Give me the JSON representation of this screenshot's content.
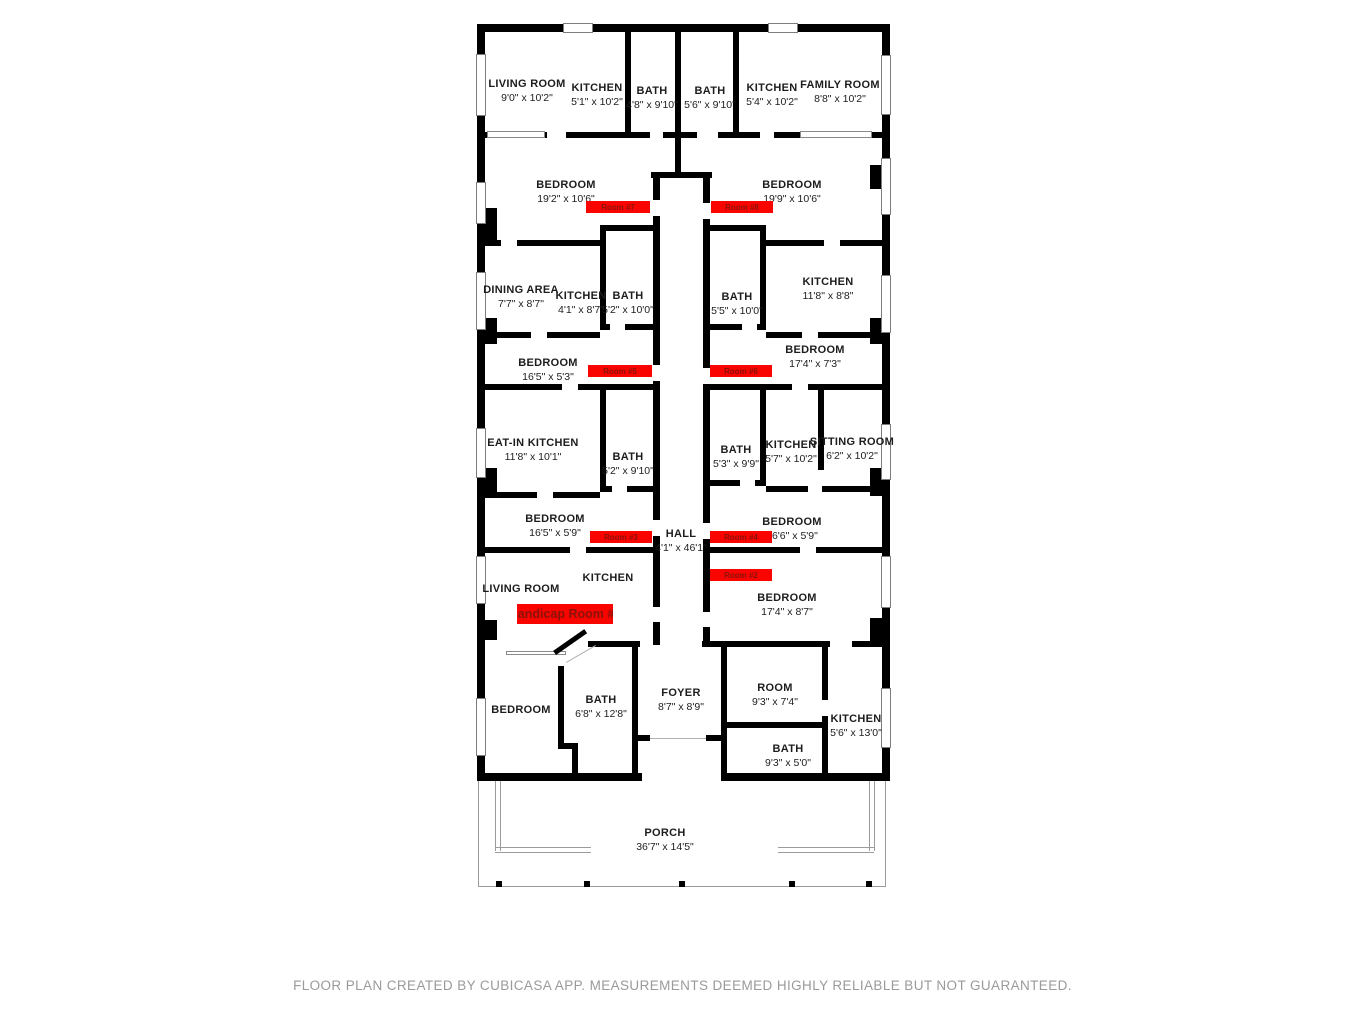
{
  "colors": {
    "wall": "#000000",
    "badge_bg": "#fa0400",
    "badge_text": "#8a1209",
    "label_text": "#1d1d1d",
    "footer_text": "#9a9a9a"
  },
  "rooms": [
    {
      "name": "LIVING ROOM",
      "dims": "9'0\" x 10'2\""
    },
    {
      "name": "KITCHEN",
      "dims": "5'1\" x 10'2\""
    },
    {
      "name": "BATH",
      "dims": "4'8\" x 9'10\""
    },
    {
      "name": "BATH",
      "dims": "5'6\" x 9'10\""
    },
    {
      "name": "KITCHEN",
      "dims": "5'4\" x 10'2\""
    },
    {
      "name": "FAMILY ROOM",
      "dims": "8'8\" x 10'2\""
    },
    {
      "name": "BEDROOM",
      "dims": "19'2\" x 10'6\""
    },
    {
      "name": "BEDROOM",
      "dims": "19'9\" x 10'6\""
    },
    {
      "name": "DINING AREA",
      "dims": "7'7\" x 8'7\""
    },
    {
      "name": "KITCHEN",
      "dims": "4'1\" x 8'7\""
    },
    {
      "name": "BATH",
      "dims": "5'2\" x 10'0\""
    },
    {
      "name": "BATH",
      "dims": "5'5\" x 10'0\""
    },
    {
      "name": "KITCHEN",
      "dims": "11'8\" x 8'8\""
    },
    {
      "name": "BEDROOM",
      "dims": "16'5\" x 5'3\""
    },
    {
      "name": "BEDROOM",
      "dims": "17'4\" x 7'3\""
    },
    {
      "name": "EAT-IN KITCHEN",
      "dims": "11'8\" x 10'1\""
    },
    {
      "name": "BATH",
      "dims": "5'2\" x 9'10\""
    },
    {
      "name": "BATH",
      "dims": "5'3\" x 9'9\""
    },
    {
      "name": "KITCHEN",
      "dims": "5'7\" x 10'2\""
    },
    {
      "name": "SITTING ROOM",
      "dims": "6'2\" x 10'2\""
    },
    {
      "name": "BEDROOM",
      "dims": "16'5\" x 5'9\""
    },
    {
      "name": "HALL",
      "dims": "4'1\" x 46'1\""
    },
    {
      "name": "BEDROOM",
      "dims": "16'6\" x 5'9\""
    },
    {
      "name": "LIVING ROOM",
      "dims": ""
    },
    {
      "name": "KITCHEN",
      "dims": ""
    },
    {
      "name": "BEDROOM",
      "dims": "17'4\" x 8'7\""
    },
    {
      "name": "BEDROOM",
      "dims": ""
    },
    {
      "name": "BATH",
      "dims": "6'8\" x 12'8\""
    },
    {
      "name": "FOYER",
      "dims": "8'7\" x 8'9\""
    },
    {
      "name": "ROOM",
      "dims": "9'3\" x 7'4\""
    },
    {
      "name": "KITCHEN",
      "dims": "5'6\" x 13'0\""
    },
    {
      "name": "BATH",
      "dims": "9'3\" x 5'0\""
    },
    {
      "name": "PORCH",
      "dims": "36'7\" x 14'5\""
    }
  ],
  "badges": [
    {
      "label": "Room #7"
    },
    {
      "label": "Room #8"
    },
    {
      "label": "Room #5"
    },
    {
      "label": "Room #6"
    },
    {
      "label": "Room #3"
    },
    {
      "label": "Room #4"
    },
    {
      "label": "Room #2"
    },
    {
      "label": "Handicap Room #1"
    }
  ],
  "footer": {
    "disclaimer": "FLOOR PLAN CREATED BY CUBICASA APP. MEASUREMENTS DEEMED HIGHLY RELIABLE BUT NOT GUARANTEED."
  }
}
